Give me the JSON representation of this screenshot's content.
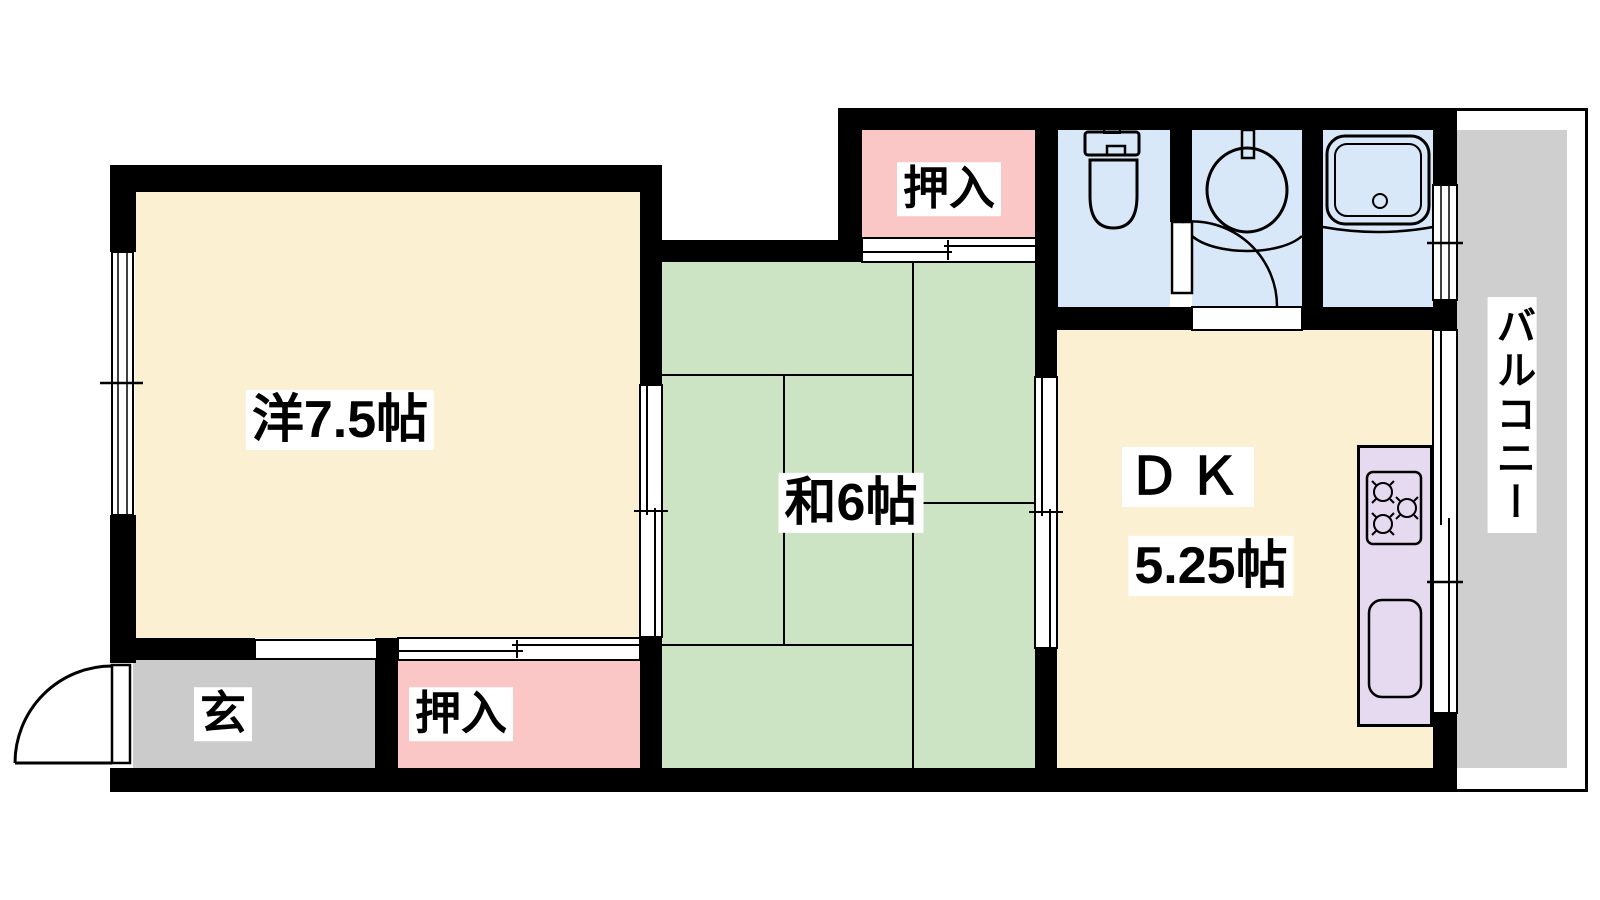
{
  "floor_plan": {
    "type": "japanese-apartment-floorplan",
    "rooms": {
      "western": {
        "label": "洋7.5帖"
      },
      "japanese": {
        "label": "和6帖"
      },
      "dk": {
        "line1": "ＤＫ",
        "line2": "5.25帖"
      },
      "closet_upper": {
        "label": "押入"
      },
      "closet_lower": {
        "label": "押入"
      },
      "entrance": {
        "label": "玄"
      },
      "balcony": {
        "label": "バルコニー"
      }
    },
    "fixtures": [
      "toilet",
      "washbasin",
      "bathtub",
      "kitchen-stove",
      "kitchen-sink",
      "entrance-door",
      "washroom-door"
    ],
    "colors": {
      "wall": "#000000",
      "western_room": "#FCF0D3",
      "dk_room": "#FCF0D3",
      "tatami_room": "#CDE4C4",
      "closet": "#FBC6C6",
      "entrance": "#CBCBCB",
      "sanitary": "#D8E8F8",
      "kitchen_counter": "#E6DAF0",
      "balcony": "#CFCFCF"
    }
  }
}
